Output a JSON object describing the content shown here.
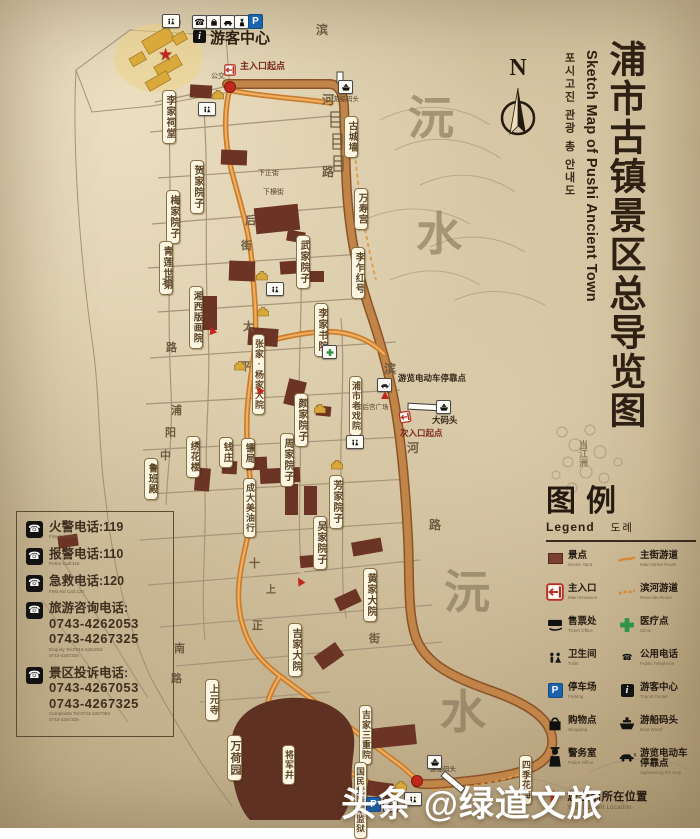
{
  "title": {
    "zh": "浦市古镇景区总导览图",
    "en": "Sketch Map of Pushi Ancient Town",
    "ko": "포시고진 관광 총 안내도"
  },
  "compass": {
    "label": "N"
  },
  "legend": {
    "title": "图例",
    "subtitle_en": "Legend",
    "subtitle_ko": "도례",
    "items": [
      {
        "icon": "spot-square-icon",
        "label": "景点",
        "caption": "Scenic Spot"
      },
      {
        "icon": "route-line-icon",
        "label": "主街游道",
        "caption": "Main Street Route"
      },
      {
        "icon": "entrance-icon",
        "label": "主入口",
        "caption": "Main Entrance"
      },
      {
        "icon": "route-dashed-icon",
        "label": "滨河游道",
        "caption": "Riverside Route"
      },
      {
        "icon": "ticket-icon",
        "label": "售票处",
        "caption": "Ticket Office"
      },
      {
        "icon": "medical-icon",
        "label": "医疗点",
        "caption": "Clinic"
      },
      {
        "icon": "wc-icon",
        "label": "卫生间",
        "caption": "Toilet"
      },
      {
        "icon": "phone-icon",
        "label": "公用电话",
        "caption": "Public Telephone"
      },
      {
        "icon": "parking-icon",
        "label": "停车场",
        "caption": "Parking"
      },
      {
        "icon": "info-icon",
        "label": "游客中心",
        "caption": "Tourist Center"
      },
      {
        "icon": "shopping-icon",
        "label": "购物点",
        "caption": "Shopping"
      },
      {
        "icon": "boat-icon",
        "label": "游船码头",
        "caption": "Boat Wharf"
      },
      {
        "icon": "police-icon",
        "label": "警务室",
        "caption": "Police Office"
      },
      {
        "icon": "ev-icon",
        "label": "游览电动车停靠点",
        "caption": "Sightseeing EV Stop"
      }
    ],
    "current_location": {
      "label": "您当前所在位置",
      "caption": "Your Current Location"
    }
  },
  "phone_box": {
    "entries": [
      {
        "title": "火警电话:119",
        "numbers": [],
        "subs": [
          "Fire Call:119"
        ]
      },
      {
        "title": "报警电话:110",
        "numbers": [],
        "subs": [
          "Police Call:110"
        ]
      },
      {
        "title": "急救电话:120",
        "numbers": [],
        "subs": [
          "First Aid Call:120"
        ]
      },
      {
        "title": "旅游咨询电话:",
        "numbers": [
          "0743-4262053",
          "0743-4267325"
        ],
        "subs": [
          "Enquiry Tel:0743-4262053",
          "0743-4267325"
        ]
      },
      {
        "title": "景区投诉电话:",
        "numbers": [
          "0743-4267053",
          "0743-4267325"
        ],
        "subs": [
          "Complaints Tel:0743-4267053",
          "0743-4267325"
        ]
      }
    ]
  },
  "map": {
    "labels": [
      {
        "text": "李家祠堂",
        "x": 162,
        "y": 90,
        "fs": 10
      },
      {
        "text": "贺家院子",
        "x": 190,
        "y": 160,
        "fs": 10
      },
      {
        "text": "梅家院子",
        "x": 166,
        "y": 190,
        "fs": 10
      },
      {
        "text": "青莲世第",
        "x": 159,
        "y": 241,
        "fs": 10
      },
      {
        "text": "湘西版画院",
        "x": 189,
        "y": 286,
        "fs": 9.5
      },
      {
        "text": "武家院子",
        "x": 296,
        "y": 235,
        "fs": 10
      },
      {
        "text": "李乍红号",
        "x": 351,
        "y": 247,
        "fs": 9.5
      },
      {
        "text": "李家书院",
        "x": 314,
        "y": 303,
        "fs": 10
      },
      {
        "text": "张家·杨家大院",
        "x": 252,
        "y": 334,
        "fs": 9
      },
      {
        "text": "浦市老戏院",
        "x": 349,
        "y": 376,
        "fs": 9
      },
      {
        "text": "颜家院子",
        "x": 294,
        "y": 393,
        "fs": 10
      },
      {
        "text": "周家院子",
        "x": 280,
        "y": 433,
        "fs": 10
      },
      {
        "text": "绣花楼",
        "x": 186,
        "y": 436,
        "fs": 9.5
      },
      {
        "text": "钱庄",
        "x": 219,
        "y": 437,
        "fs": 9.5
      },
      {
        "text": "镖局",
        "x": 241,
        "y": 438,
        "fs": 9.5
      },
      {
        "text": "鲁班殿",
        "x": 144,
        "y": 458,
        "fs": 9.5
      },
      {
        "text": "成大美油行",
        "x": 243,
        "y": 478,
        "fs": 9
      },
      {
        "text": "芳家院子",
        "x": 329,
        "y": 475,
        "fs": 10
      },
      {
        "text": "吴家院子",
        "x": 313,
        "y": 516,
        "fs": 10
      },
      {
        "text": "黄家大院",
        "x": 363,
        "y": 568,
        "fs": 10
      },
      {
        "text": "吉家大院",
        "x": 288,
        "y": 623,
        "fs": 10
      },
      {
        "text": "上元寺",
        "x": 205,
        "y": 679,
        "fs": 9.5
      },
      {
        "text": "吉家三重院",
        "x": 359,
        "y": 705,
        "fs": 9
      },
      {
        "text": "万荷园",
        "x": 227,
        "y": 735,
        "fs": 11
      },
      {
        "text": "将军井",
        "x": 282,
        "y": 745,
        "fs": 9
      },
      {
        "text": "国民党陆军监狱",
        "x": 354,
        "y": 762,
        "fs": 8.5
      },
      {
        "text": "四季花海",
        "x": 519,
        "y": 755,
        "fs": 9
      },
      {
        "text": "万寿宫",
        "x": 354,
        "y": 188,
        "fs": 9.5
      },
      {
        "text": "古城墙",
        "x": 344,
        "y": 116,
        "fs": 9.5
      }
    ],
    "street_chars": [
      {
        "t": "滨",
        "x": 316,
        "y": 24,
        "s": 12
      },
      {
        "t": "河",
        "x": 322,
        "y": 94,
        "s": 12
      },
      {
        "t": "路",
        "x": 322,
        "y": 166,
        "s": 12
      },
      {
        "t": "滨",
        "x": 384,
        "y": 363,
        "s": 12
      },
      {
        "t": "河",
        "x": 407,
        "y": 442,
        "s": 12
      },
      {
        "t": "路",
        "x": 429,
        "y": 519,
        "s": 12
      },
      {
        "t": "太",
        "x": 243,
        "y": 322,
        "s": 11
      },
      {
        "t": "平",
        "x": 240,
        "y": 362,
        "s": 11
      },
      {
        "t": "后",
        "x": 245,
        "y": 216,
        "s": 11
      },
      {
        "t": "街",
        "x": 241,
        "y": 241,
        "s": 11
      },
      {
        "t": "北",
        "x": 162,
        "y": 277,
        "s": 11
      },
      {
        "t": "路",
        "x": 166,
        "y": 343,
        "s": 11
      },
      {
        "t": "浦",
        "x": 171,
        "y": 406,
        "s": 11
      },
      {
        "t": "阳",
        "x": 165,
        "y": 428,
        "s": 11
      },
      {
        "t": "中",
        "x": 160,
        "y": 451,
        "s": 11
      },
      {
        "t": "南",
        "x": 174,
        "y": 644,
        "s": 11
      },
      {
        "t": "路",
        "x": 171,
        "y": 674,
        "s": 11
      },
      {
        "t": "十",
        "x": 249,
        "y": 559,
        "s": 11
      },
      {
        "t": "上",
        "x": 266,
        "y": 586,
        "s": 10
      },
      {
        "t": "正",
        "x": 252,
        "y": 621,
        "s": 11
      },
      {
        "t": "街",
        "x": 369,
        "y": 634,
        "s": 11
      }
    ],
    "water_chars": [
      {
        "t": "沅",
        "x": 408,
        "y": 96
      },
      {
        "t": "水",
        "x": 416,
        "y": 212
      },
      {
        "t": "沅",
        "x": 444,
        "y": 570
      },
      {
        "t": "水",
        "x": 440,
        "y": 690
      }
    ],
    "vertical_texts": [
      {
        "t": "当江洲",
        "x": 578,
        "y": 440,
        "s": 9
      }
    ],
    "texts": [
      {
        "t": "卫生间",
        "x": 167,
        "y": 20,
        "s": 4.6,
        "c": "#222"
      },
      {
        "t": "游客中心",
        "x": 210,
        "y": 31,
        "s": 15,
        "c": "#2e2113",
        "b": 1
      },
      {
        "t": "主入口起点",
        "x": 240,
        "y": 62,
        "s": 9,
        "c": "#7a2a1c",
        "b": 1
      },
      {
        "t": "公交",
        "x": 211,
        "y": 73,
        "s": 7,
        "c": "#57432c"
      },
      {
        "t": "游船码头",
        "x": 333,
        "y": 96,
        "s": 6.5,
        "c": "#4a3a26"
      },
      {
        "t": "下正街",
        "x": 258,
        "y": 170,
        "s": 7,
        "c": "#57432c"
      },
      {
        "t": "下横街",
        "x": 263,
        "y": 189,
        "s": 7,
        "c": "#57432c"
      },
      {
        "t": "游览电动车停靠点",
        "x": 398,
        "y": 374,
        "s": 8.5,
        "c": "#33281a",
        "b": 1
      },
      {
        "t": "天后宫广场",
        "x": 356,
        "y": 404,
        "s": 6.5,
        "c": "#57432c"
      },
      {
        "t": "大码头",
        "x": 432,
        "y": 416,
        "s": 8.5,
        "c": "#33281a",
        "b": 1
      },
      {
        "t": "次入口起点",
        "x": 400,
        "y": 429,
        "s": 8.5,
        "c": "#7a2a1c",
        "b": 1
      },
      {
        "t": "游船码头",
        "x": 430,
        "y": 766,
        "s": 6.5,
        "c": "#4a3a26"
      }
    ],
    "markers": [
      {
        "t": "wc",
        "x": 162,
        "y": 14
      },
      {
        "t": "phone",
        "x": 192,
        "y": 15
      },
      {
        "t": "bag",
        "x": 206,
        "y": 15
      },
      {
        "t": "car",
        "x": 220,
        "y": 15
      },
      {
        "t": "police",
        "x": 234,
        "y": 15
      },
      {
        "t": "P",
        "x": 248,
        "y": 14
      },
      {
        "t": "i",
        "x": 193,
        "y": 30
      },
      {
        "t": "gate",
        "x": 224,
        "y": 64
      },
      {
        "t": "dot",
        "x": 224,
        "y": 81
      },
      {
        "t": "star",
        "x": 158,
        "y": 46
      },
      {
        "t": "temple",
        "x": 211,
        "y": 89
      },
      {
        "t": "wc",
        "x": 198,
        "y": 102
      },
      {
        "t": "boat",
        "x": 338,
        "y": 80
      },
      {
        "t": "temple",
        "x": 255,
        "y": 270
      },
      {
        "t": "wc",
        "x": 266,
        "y": 282
      },
      {
        "t": "temple",
        "x": 256,
        "y": 306
      },
      {
        "t": "cross",
        "x": 322,
        "y": 345
      },
      {
        "t": "temple",
        "x": 233,
        "y": 360
      },
      {
        "t": "ev",
        "x": 377,
        "y": 378
      },
      {
        "t": "arrow",
        "x": 381,
        "y": 391,
        "rot": 180
      },
      {
        "t": "temple",
        "x": 313,
        "y": 403
      },
      {
        "t": "boat",
        "x": 436,
        "y": 400
      },
      {
        "t": "gate",
        "x": 399,
        "y": 411,
        "rot": -10
      },
      {
        "t": "temple",
        "x": 330,
        "y": 459
      },
      {
        "t": "wc",
        "x": 346,
        "y": 435
      },
      {
        "t": "arrow",
        "x": 208,
        "y": 326,
        "rot": 160
      },
      {
        "t": "arrow",
        "x": 255,
        "y": 386,
        "rot": 140
      },
      {
        "t": "arrow",
        "x": 296,
        "y": 577,
        "rot": 150
      },
      {
        "t": "temple",
        "x": 394,
        "y": 780
      },
      {
        "t": "wc",
        "x": 404,
        "y": 792
      },
      {
        "t": "dot",
        "x": 411,
        "y": 775
      },
      {
        "t": "boat",
        "x": 427,
        "y": 755
      },
      {
        "t": "P",
        "x": 366,
        "y": 797
      },
      {
        "t": "bag",
        "x": 383,
        "y": 798
      }
    ]
  },
  "watermark": "头条 @绿道文旅",
  "colors": {
    "parchment": "#d5c5a2",
    "ink": "#2e2113",
    "building": "#6b3424",
    "highlight_gold": "#d9a93c",
    "main_route_orange": "#d88733",
    "river_road_tan": "#c18449",
    "accent_red": "#c0271d",
    "medical_green": "#2e9447",
    "parking_blue": "#1b63ad"
  }
}
